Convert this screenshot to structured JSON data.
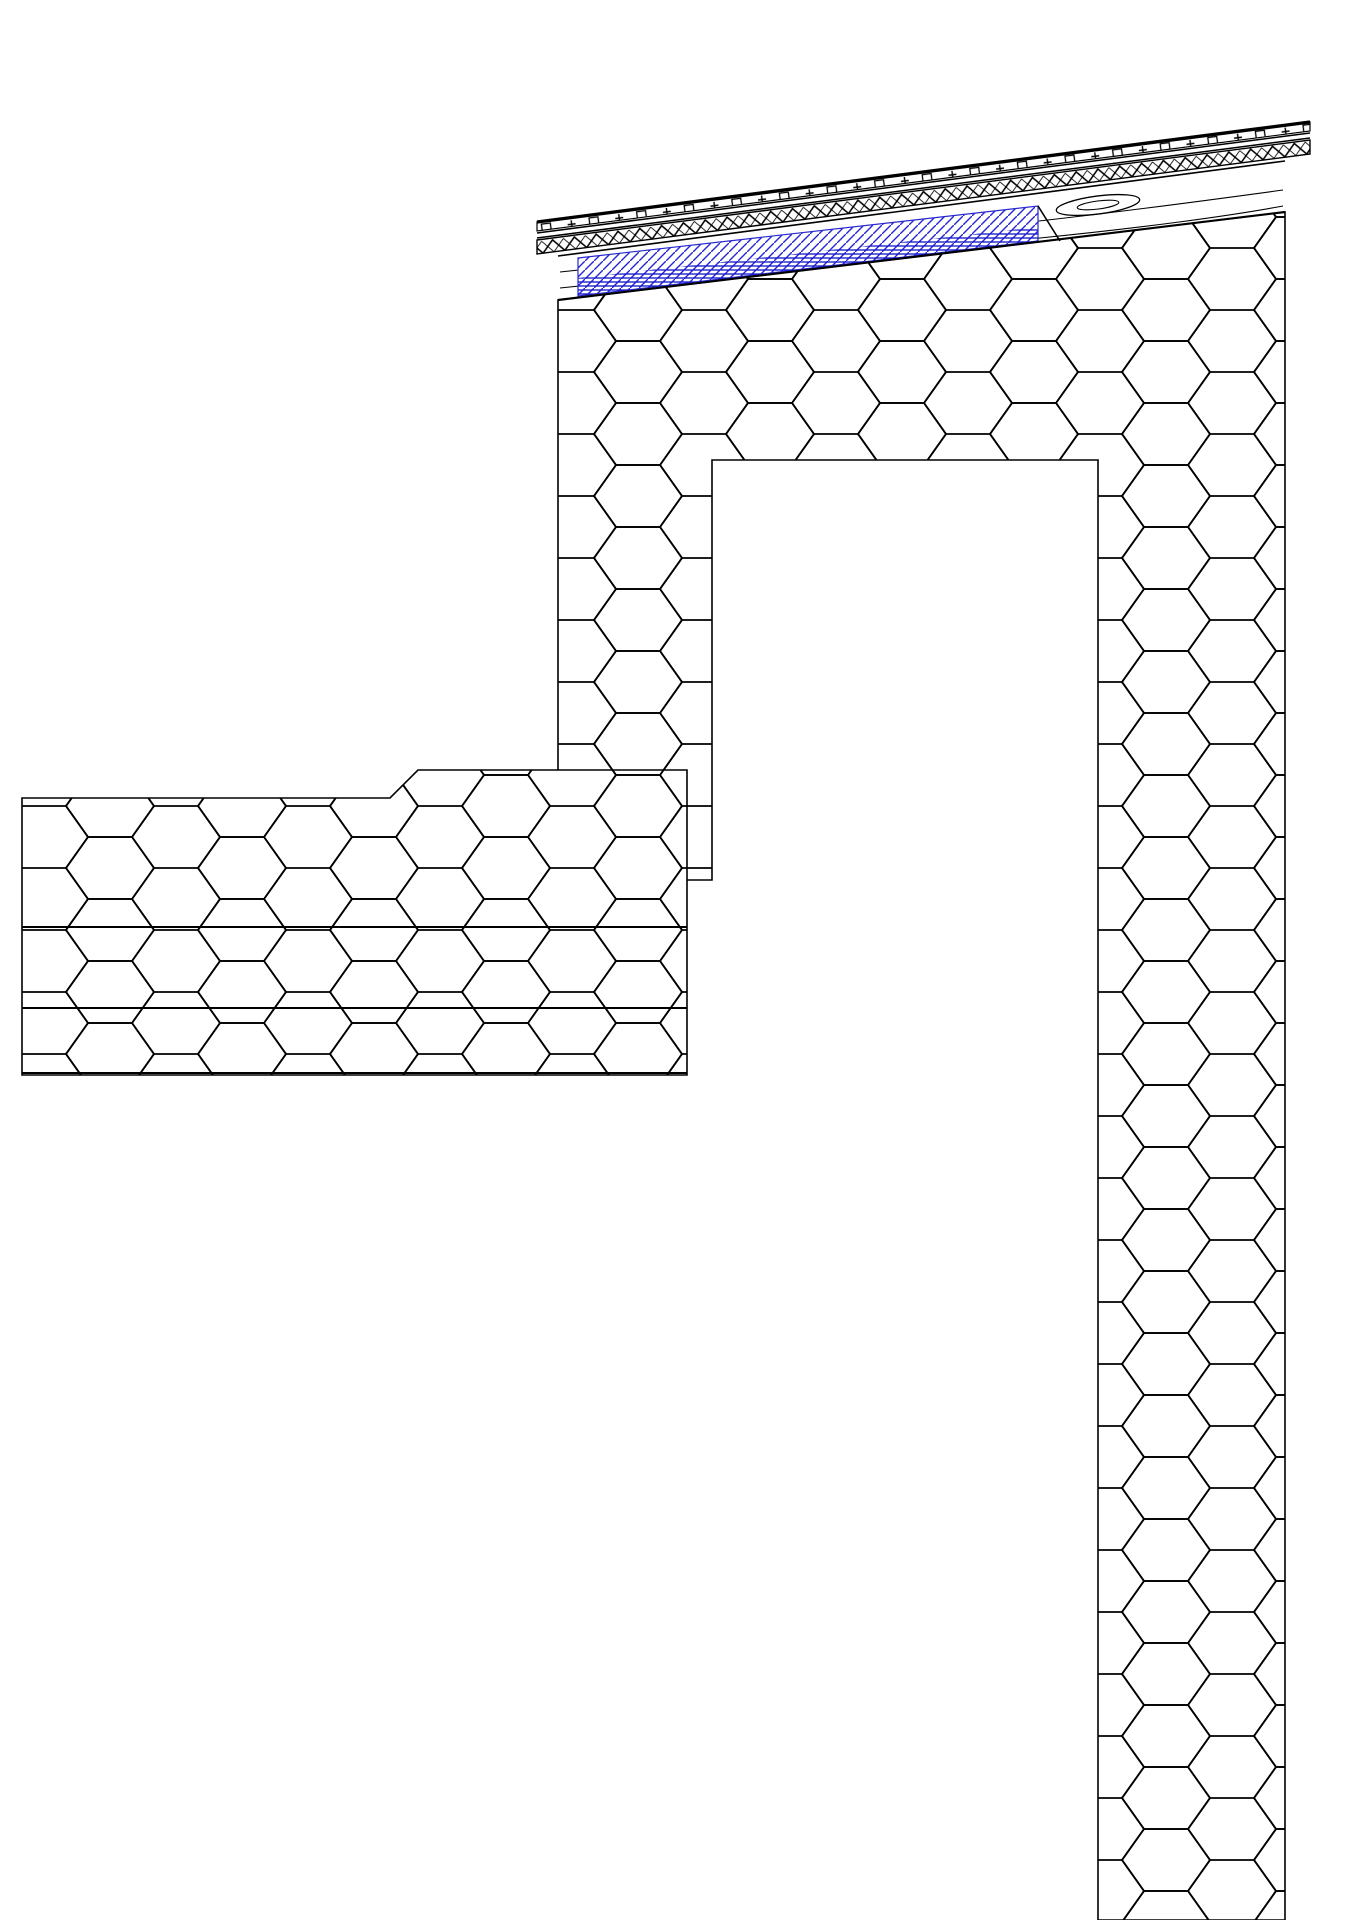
{
  "meta": {
    "title": "construction-detail-roof-wall-junction",
    "canvas": {
      "w": 1357,
      "h": 1920
    },
    "colors": {
      "line": "#000000",
      "marker_blue": "#1c1ce0",
      "wood_hatch_blue": "#2828d0",
      "wood_grain_blue": "#1414c8",
      "white": "#ffffff"
    }
  },
  "hex_regions": [
    {
      "name": "roof-parapet-and-wall-insulation",
      "points": [
        [
          558,
          300
        ],
        [
          1285,
          212
        ],
        [
          1285,
          1920
        ],
        [
          1098,
          1920
        ],
        [
          1098,
          460
        ],
        [
          712,
          460
        ],
        [
          712,
          880
        ],
        [
          558,
          880
        ]
      ]
    },
    {
      "name": "flat-roof-insulation",
      "points": [
        [
          22,
          798
        ],
        [
          390,
          798
        ],
        [
          418,
          770
        ],
        [
          687,
          770
        ],
        [
          687,
          1075
        ],
        [
          22,
          1075
        ]
      ]
    }
  ],
  "insulation_lines": [
    {
      "name": "flat-roof-insulation-layer-joint",
      "pts": [
        [
          22,
          927
        ],
        [
          687,
          927
        ]
      ]
    },
    {
      "name": "flat-roof-insulation-layer-joint",
      "pts": [
        [
          22,
          1008
        ],
        [
          687,
          1008
        ]
      ]
    },
    {
      "name": "flat-roof-insulation-bottom",
      "pts": [
        [
          22,
          1073
        ],
        [
          687,
          1073
        ]
      ]
    }
  ],
  "timber": {
    "name": "roof-timber-beam",
    "body": [
      [
        558,
        256
      ],
      [
        1285,
        161
      ],
      [
        1285,
        212
      ],
      [
        558,
        300
      ]
    ],
    "blue_part": [
      [
        578,
        258
      ],
      [
        1038,
        206
      ],
      [
        1038,
        241
      ],
      [
        578,
        296
      ]
    ],
    "blue_grain_part": [
      [
        578,
        278
      ],
      [
        1038,
        227
      ],
      [
        1038,
        241
      ],
      [
        578,
        296
      ]
    ],
    "joint_line": [
      [
        1038,
        206
      ],
      [
        1060,
        241
      ]
    ],
    "grain": [
      {
        "d": "M560,272 C 700,258 860,240 1030,222 C 1120,212 1210,200 1283,190"
      },
      {
        "d": "M560,288 C 720,272 900,252 1040,238 C 1140,228 1230,216 1283,206"
      }
    ],
    "knot": {
      "cx": 1098,
      "cy": 205,
      "rx": 42,
      "ry": 9,
      "rot": -7.4
    }
  },
  "roof_layers": {
    "top_line": {
      "name": "roof-covering-line",
      "x1": 537,
      "y1": 222,
      "x2": 1310,
      "y2": 122,
      "w": 3.4
    },
    "marks_strip": {
      "name": "roof-membrane-with-fixings",
      "points": [
        [
          537,
          222
        ],
        [
          1310,
          122
        ],
        [
          1310,
          131
        ],
        [
          537,
          231
        ]
      ]
    },
    "sheathing_lines": [
      {
        "x1": 537,
        "y1": 233,
        "x2": 1310,
        "y2": 133
      },
      {
        "x1": 537,
        "y1": 238,
        "x2": 1310,
        "y2": 138
      }
    ],
    "zigzag_strip": {
      "name": "roof-decking-zigzag-layer",
      "points": [
        [
          537,
          240
        ],
        [
          1310,
          140
        ],
        [
          1310,
          154
        ],
        [
          537,
          254
        ]
      ]
    },
    "fascia_jog": {
      "points": [
        [
          1053,
          159
        ],
        [
          1092,
          154
        ],
        [
          1092,
          146
        ],
        [
          1053,
          151
        ]
      ]
    }
  },
  "eave": {
    "name": "eaves-gutter-detail",
    "drip": [
      [
        1305,
        121
      ],
      [
        1341,
        116
      ],
      [
        1341,
        186
      ]
    ],
    "bracket_a": [
      [
        1293,
        100
      ],
      [
        1341,
        126
      ]
    ],
    "bracket_b": [
      [
        1337,
        108
      ],
      [
        1322,
        200
      ],
      [
        1303,
        193
      ]
    ]
  },
  "parapet": {
    "outer_line_x": 538,
    "outer_line_y": [
      218,
      703
    ],
    "membrane_strip": {
      "name": "parapet-waterproofing-membrane",
      "x": 541,
      "y": 215,
      "w": 16,
      "h": 490
    },
    "zigzag_strip": {
      "name": "parapet-protection-zigzag",
      "x": 558,
      "y": 218,
      "w": 14,
      "h": 487
    },
    "cap_mesh": {
      "name": "parapet-cap-reinforcement-mesh",
      "x": 548,
      "y": 226,
      "w": 80,
      "h": 14
    },
    "cap_zig": {
      "points": [
        [
          558,
          240
        ],
        [
          650,
          229
        ],
        [
          650,
          241
        ],
        [
          558,
          252
        ]
      ]
    }
  },
  "flat_roof_layers": {
    "name": "flat-roof-membrane-build-up",
    "zig1": {
      "top": [
        [
          22,
          748
        ],
        [
          390,
          748
        ],
        [
          418,
          722
        ],
        [
          557,
          722
        ]
      ],
      "h": 14
    },
    "membrane": {
      "top": [
        [
          22,
          763
        ],
        [
          390,
          763
        ],
        [
          418,
          737
        ],
        [
          557,
          737
        ]
      ],
      "h": 16
    },
    "zig2": {
      "top": [
        [
          22,
          780
        ],
        [
          390,
          780
        ],
        [
          418,
          754
        ],
        [
          557,
          754
        ]
      ],
      "h": 14
    },
    "baseline": [
      [
        22,
        795
      ],
      [
        390,
        795
      ],
      [
        418,
        769
      ],
      [
        557,
        769
      ]
    ],
    "step_mesh_block": {
      "x": 388,
      "y": 757,
      "w": 44,
      "h": 16
    }
  },
  "gravel": {
    "name": "gravel-ballast-layer",
    "clip": [
      [
        22,
        612
      ],
      [
        543,
        612
      ],
      [
        543,
        698
      ],
      [
        465,
        705
      ],
      [
        418,
        717
      ],
      [
        390,
        744
      ],
      [
        22,
        744
      ]
    ],
    "band": {
      "x0": 30,
      "x1": 536,
      "y0": 652,
      "y1": 732
    },
    "seed": 7,
    "count": 120
  },
  "beam_concrete": {
    "name": "concrete-ring-beam",
    "points": [
      [
        712,
        397
      ],
      [
        1085,
        347
      ],
      [
        1085,
        452
      ],
      [
        712,
        452
      ]
    ]
  },
  "masonry": {
    "name": "masonry-wall",
    "x": 712,
    "y": 452,
    "w": 378,
    "h": 1468
  },
  "lower_wall": {
    "name": "masonry-wall-below-slab",
    "x": 512,
    "y": 1404,
    "w": 200,
    "h": 516
  },
  "speckle_band": {
    "name": "mortar-levelling-band",
    "x": 712,
    "y": 1077,
    "w": 378,
    "h": 20
  },
  "slab": {
    "name": "reinforced-concrete-slab",
    "x": 22,
    "y": 1097,
    "w": 981,
    "h": 307
  },
  "soil_ticks": {
    "name": "separation-layer-ticks",
    "x0": 30,
    "x1": 726,
    "rows": [
      {
        "y": 1104,
        "len": 24
      },
      {
        "y": 1116,
        "len": 24
      }
    ],
    "step": 26
  },
  "wall_joint_line": {
    "x": 1003,
    "y1": 1097,
    "y2": 1920
  },
  "ceiling_strip": {
    "name": "interior-ceiling-finish",
    "x": 22,
    "y": 1480,
    "w": 470,
    "h": 20
  },
  "plaster_strip": {
    "name": "interior-wall-plaster",
    "x": 497,
    "y": 1404,
    "w": 15,
    "h": 516
  },
  "vapor_barrier": {
    "name": "vapour-barrier-dashed",
    "bars": [
      [
        22,
        88
      ],
      [
        195,
        75
      ],
      [
        355,
        50
      ],
      [
        470,
        60
      ]
    ],
    "mesh_patches": [
      [
        115,
        75
      ],
      [
        275,
        75
      ],
      [
        410,
        55
      ],
      [
        535,
        80
      ]
    ],
    "bar_y": 1077,
    "bar_h": 13,
    "patch_y": 1087,
    "patch_h": 13,
    "base_line_y": 1095,
    "foot": {
      "x": 620,
      "y": 1066,
      "w": 83,
      "h": 13
    },
    "upstand": {
      "name": "membrane-upstand",
      "x": 690,
      "y": 877,
      "w": 13,
      "h": 203
    }
  },
  "mesh_strips": [
    {
      "name": "adhesive-mesh-parapet-wall-face",
      "x": 700,
      "y": 277,
      "w": 14,
      "h": 820,
      "seg": null
    },
    {
      "name": "adhesive-mesh-outer-wall-face",
      "x": 1088,
      "y": 300,
      "w": 14,
      "h": 1620,
      "seg": [
        130,
        60
      ]
    }
  ],
  "wall_lines": [
    {
      "x1": 712,
      "y1": 452,
      "x2": 712,
      "y2": 1097,
      "w": 1.6
    },
    {
      "x1": 1090,
      "y1": 347,
      "x2": 1090,
      "y2": 1920,
      "w": 1.6
    },
    {
      "x1": 712,
      "y1": 452,
      "x2": 1085,
      "y2": 452,
      "w": 2
    },
    {
      "x1": 22,
      "y1": 1097,
      "x2": 1003,
      "y2": 1097,
      "w": 3
    },
    {
      "x1": 22,
      "y1": 1404,
      "x2": 1003,
      "y2": 1404,
      "w": 2
    }
  ],
  "render_line": {
    "name": "outer-render-with-fixings",
    "x1": 1283,
    "x2": 1292,
    "y1": 158,
    "y2": 1920,
    "dot_start": 173,
    "dot_step": 68
  },
  "anchors_right": {
    "name": "insulation-anchor-dowel",
    "list": [
      {
        "y": 405
      },
      {
        "y": 884
      },
      {
        "y": 1454
      }
    ],
    "wavy_x0": 1032,
    "wavy_x1": 1090,
    "shaft_x1": 1266,
    "plate_w": 11,
    "plate_h": 56
  },
  "anchor_parapet": {
    "name": "parapet-anchor-dowel",
    "plate": [
      572,
      483,
      8,
      75
    ],
    "shaft_y": 523,
    "shaft_x0": 580,
    "shaft_x1": 762,
    "wavy_x1": 830
  },
  "screw_horizontal": {
    "name": "parapet-horizontal-screw",
    "y": 693,
    "x1": 545,
    "x2": 706,
    "head_h": 24
  },
  "screws_vertical": [
    {
      "name": "roof-screw",
      "x": 602,
      "y1": 237,
      "y2": 322,
      "kind": "ladder"
    },
    {
      "name": "roof-screw",
      "x": 790,
      "y1": 268,
      "y2": 388,
      "thread_from": 335,
      "kind": "rod"
    },
    {
      "name": "roof-screw",
      "x": 1005,
      "y1": 235,
      "y2": 400,
      "thread_from": 307,
      "tip": 418,
      "kind": "rod"
    },
    {
      "name": "roof-screw",
      "x": 1133,
      "y1": 158,
      "y2": 245,
      "kind": "ladder"
    },
    {
      "name": "roof-screw",
      "x": 1233,
      "y1": 153,
      "y2": 235,
      "kind": "ladder"
    }
  ],
  "markers": {
    "name": "moisture-direction-markers",
    "up_large": [
      [
        633,
        240
      ],
      [
        780,
        233
      ],
      [
        737,
        300
      ],
      [
        835,
        287
      ],
      [
        943,
        272
      ],
      [
        633,
        315
      ],
      [
        633,
        398
      ],
      [
        633,
        503
      ],
      [
        633,
        610
      ],
      [
        86,
        857
      ],
      [
        248,
        857
      ],
      [
        393,
        857
      ],
      [
        86,
        905
      ],
      [
        248,
        905
      ],
      [
        393,
        905
      ],
      [
        83,
        948
      ],
      [
        245,
        948
      ],
      [
        390,
        948
      ],
      [
        83,
        995
      ],
      [
        245,
        995
      ],
      [
        390,
        995
      ],
      [
        72,
        1050
      ],
      [
        215,
        1050
      ],
      [
        343,
        1050
      ]
    ],
    "right_large": {
      "y": 817,
      "xs": [
        148,
        228,
        310,
        377,
        458,
        520
      ]
    },
    "up_small": [
      [
        165,
        746
      ],
      [
        165,
        761
      ],
      [
        165,
        777
      ],
      [
        330,
        746
      ],
      [
        330,
        761
      ],
      [
        330,
        777
      ]
    ],
    "size_large": [
      46,
      40
    ],
    "size_small": [
      21,
      15
    ]
  }
}
